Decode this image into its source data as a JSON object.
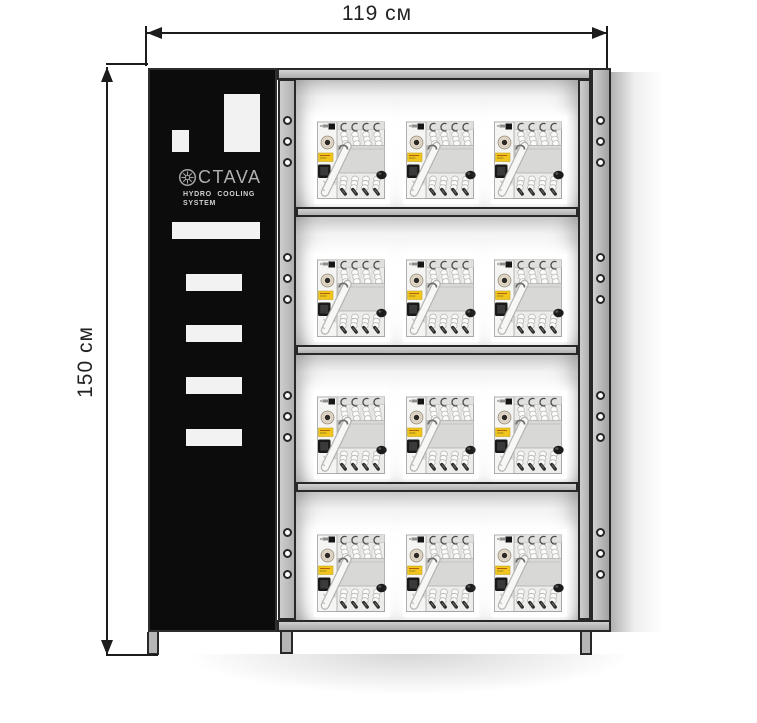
{
  "annotations": {
    "width_label": "119 см",
    "height_label": "150 см"
  },
  "control_panel": {
    "emblem_icon": "octava-rosette",
    "brand_text": "CTAVA",
    "subtitle_line1": "HYDRO COOLING",
    "subtitle_line2": "SYSTEM",
    "vent_slot_count": 4
  },
  "rack": {
    "shelf_count": 4,
    "devices_per_shelf": 3,
    "device_total": 12,
    "mounting_holes_per_bay_side": 3,
    "device_name": "hydro-cooling-unit"
  },
  "colors": {
    "panel_black": "#0c0c0c",
    "frame_gray": "#c2c2c2",
    "frame_outline": "#282828",
    "cutout_white": "#f2f2f2",
    "device_label_yellow": "#f2c51d",
    "dial_tan": "#e9dfcf",
    "dimension_line": "#1c1c1c"
  }
}
